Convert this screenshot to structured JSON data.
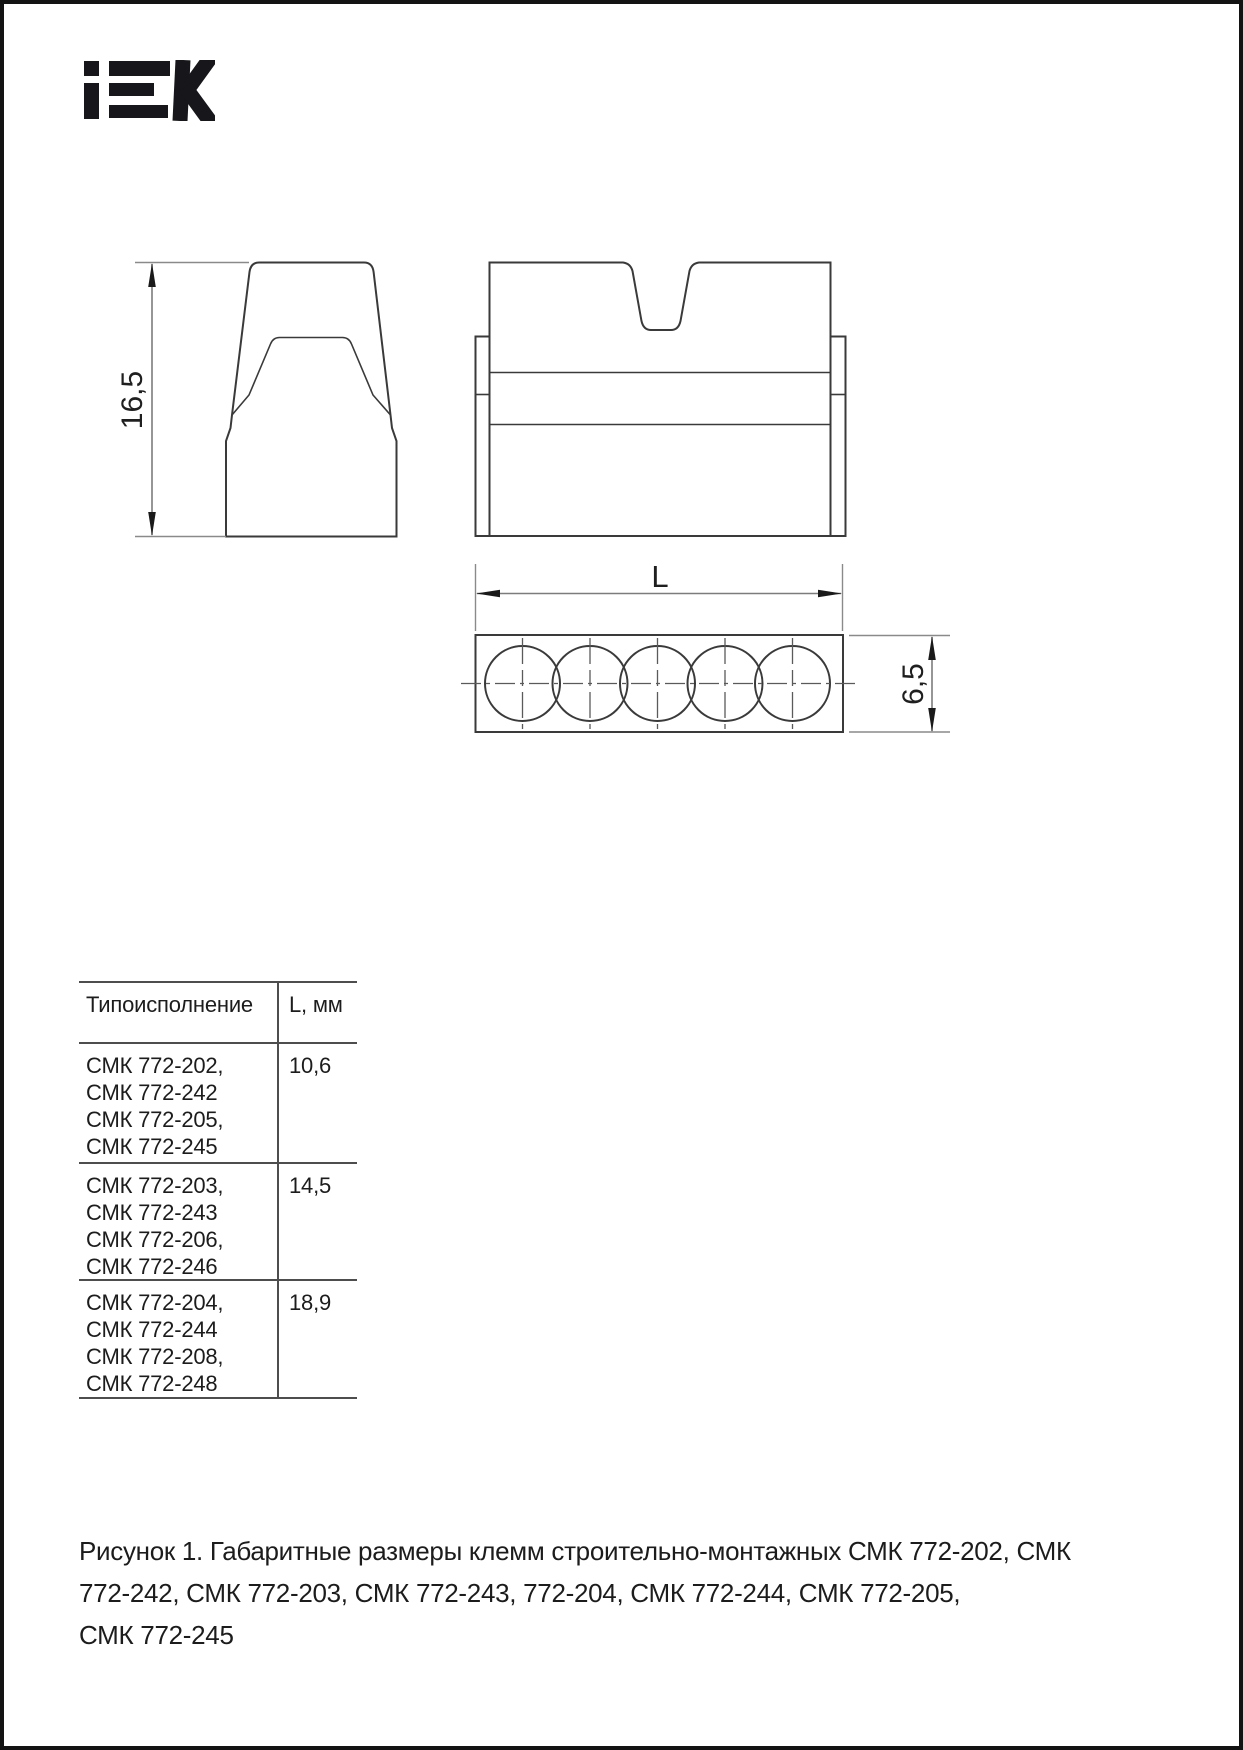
{
  "logo": {
    "brand": "IEK"
  },
  "drawing": {
    "side_view": {
      "height_dim": "16,5"
    },
    "plan_view": {
      "length_dim": "L",
      "width_dim": "6,5"
    }
  },
  "table": {
    "headers": {
      "type": "Типоисполнение",
      "length": "L, мм"
    },
    "rows": [
      {
        "types": [
          "СМК 772-202,",
          "СМК 772-242",
          "СМК 772-205,",
          "СМК 772-245"
        ],
        "length_mm": "10,6"
      },
      {
        "types": [
          "СМК 772-203,",
          "СМК 772-243",
          "СМК 772-206,",
          "СМК 772-246"
        ],
        "length_mm": "14,5"
      },
      {
        "types": [
          "СМК 772-204,",
          "СМК 772-244",
          "СМК 772-208,",
          "СМК 772-248"
        ],
        "length_mm": "18,9"
      }
    ]
  },
  "caption": {
    "lines": [
      "Рисунок 1. Габаритные размеры клемм строительно-монтажных СМК 772-202, СМК",
      "772-242, СМК 772-203, СМК 772-243, 772-204, СМК 772-244, СМК 772-205,",
      "СМК 772-245"
    ]
  }
}
